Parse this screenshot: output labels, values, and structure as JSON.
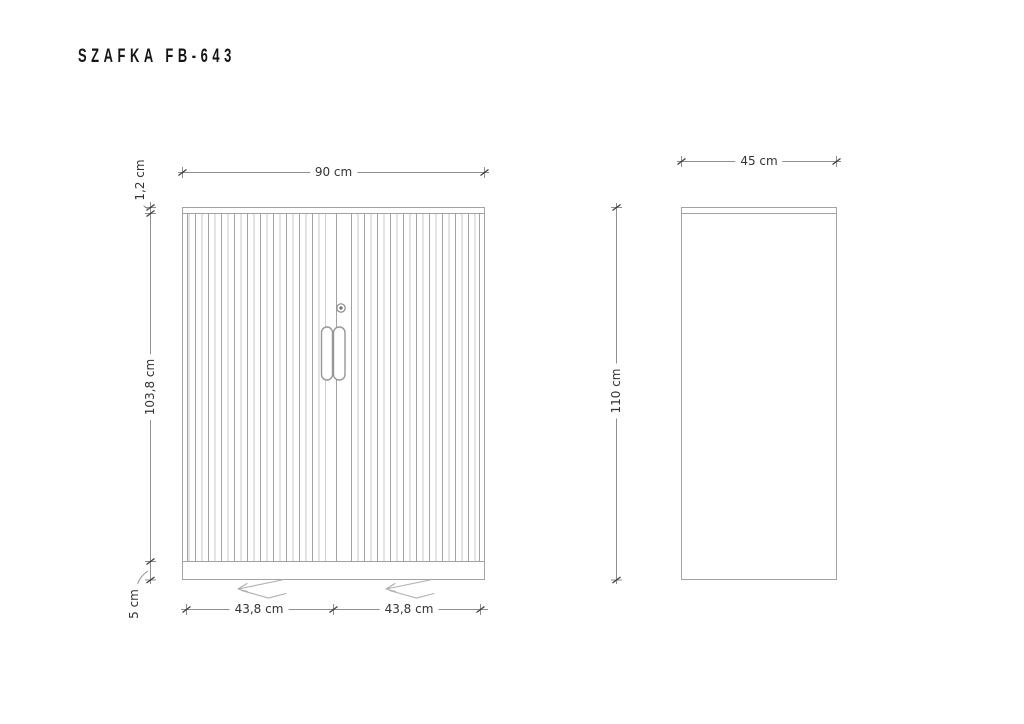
{
  "title": "SZAFKA FB-643",
  "views": {
    "front": {
      "label": "front view",
      "dimensions": {
        "width": "90 cm",
        "top_panel_height": "1,2 cm",
        "door_height": "103,8 cm",
        "plinth_height": "5 cm",
        "left_door_width": "43,8 cm",
        "right_door_width": "43,8 cm"
      }
    },
    "side": {
      "label": "side view",
      "dimensions": {
        "depth": "45 cm",
        "height": "110 cm"
      }
    }
  },
  "colors": {
    "background": "#ffffff",
    "title": "#151515",
    "text": "#333333",
    "outline": "#a3a3a3",
    "dimension": "#8f8f8f",
    "tick": "#3c3c3c",
    "slat_light": "#c8c8c8",
    "slat_dark": "#a2a2a2",
    "slide_symbol": "#b0b0b0"
  }
}
